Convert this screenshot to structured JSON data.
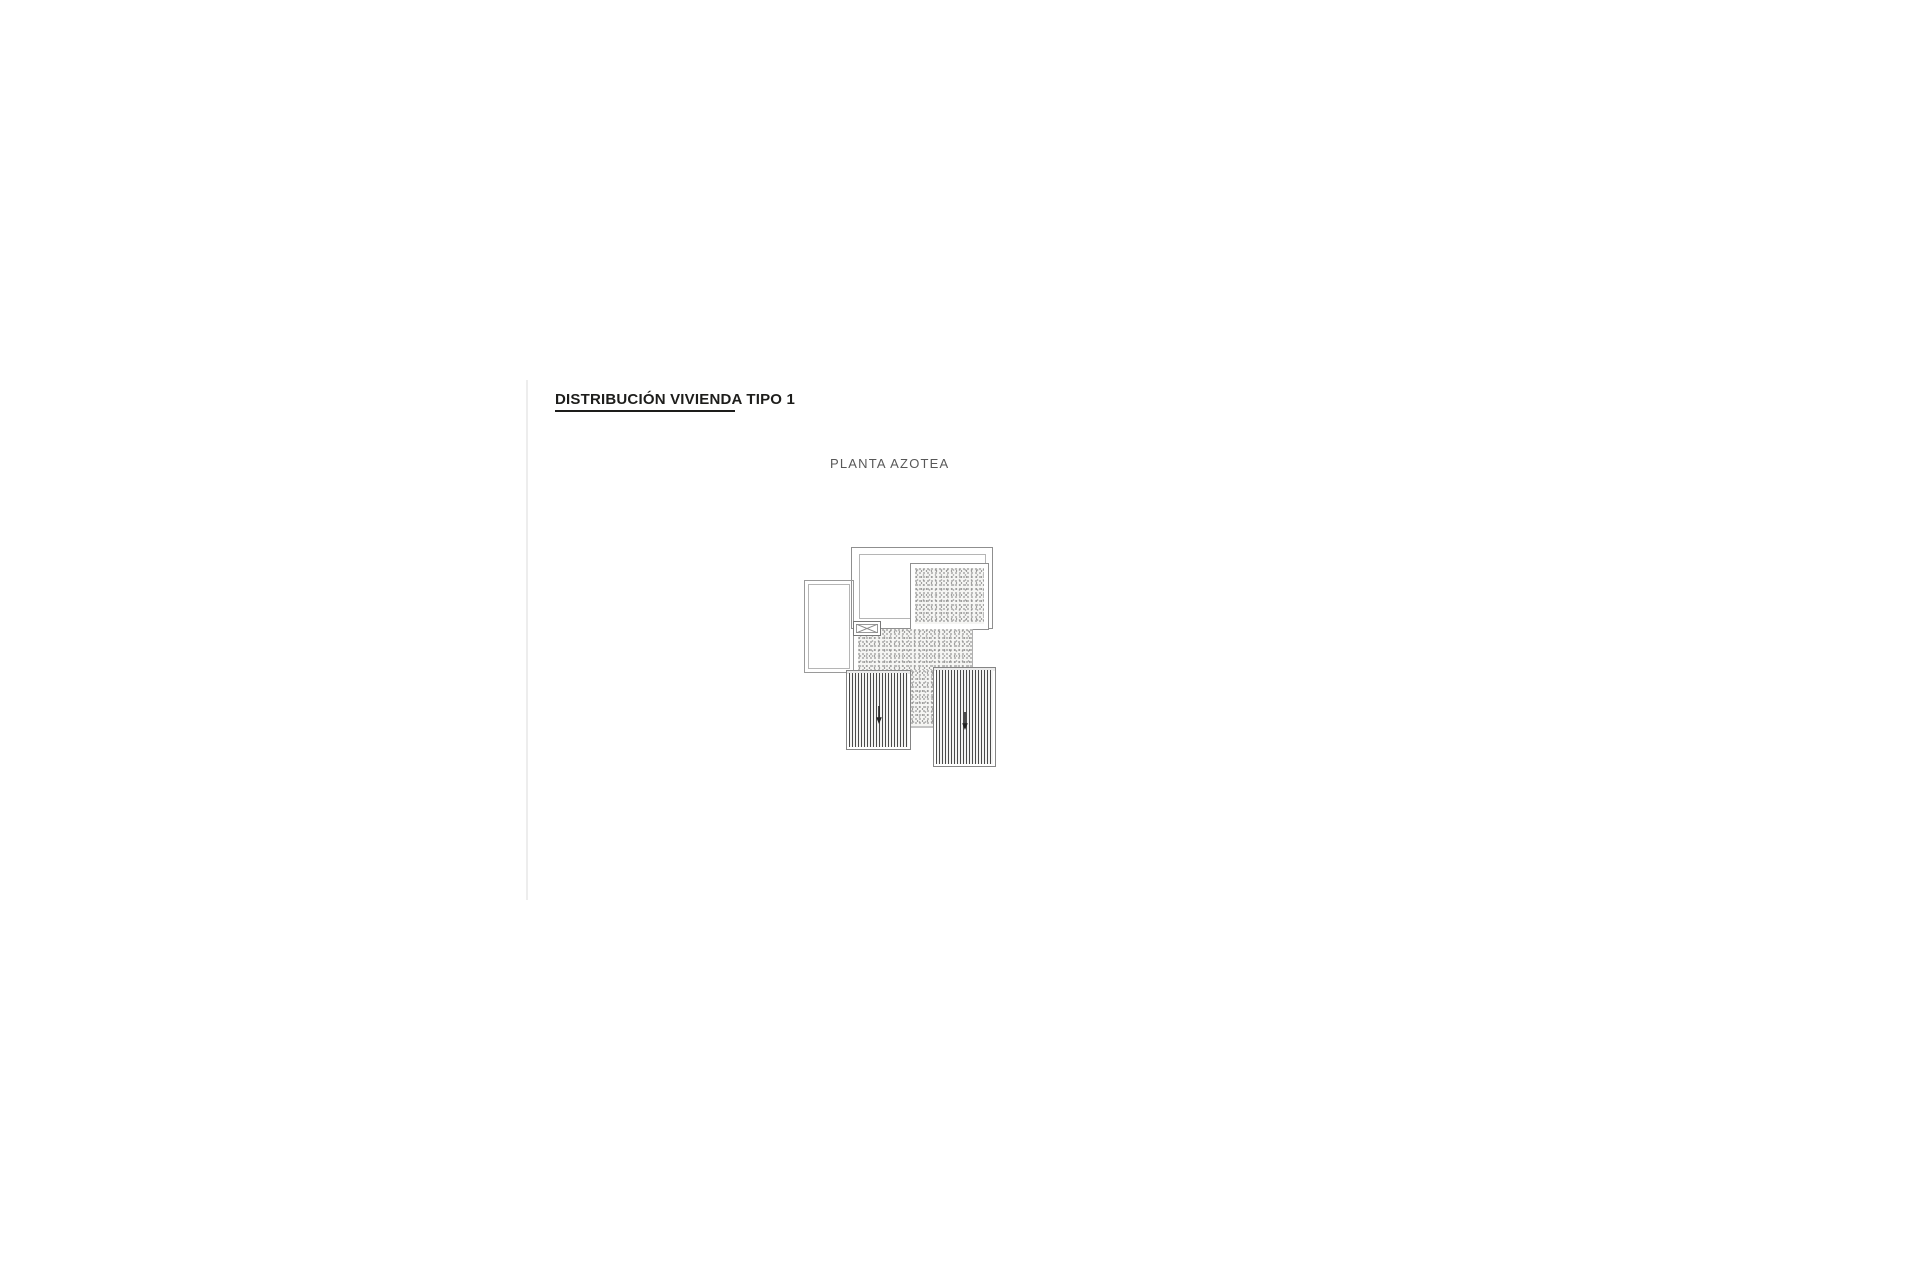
{
  "page": {
    "background": "#ffffff",
    "separator_color": "#ededed"
  },
  "header": {
    "title": "DISTRIBUCIÓN VIVIENDA TIPO 1",
    "title_color": "#1d1d1b",
    "underline_color": "#1d1d1b"
  },
  "figure": {
    "caption": "PLANTA AZOTEA",
    "caption_color": "#585858"
  },
  "plan": {
    "line_color": "#8f8f8f",
    "hatch_style": "stipple-gravel",
    "elements": [
      {
        "name": "roof-perimeter-outline"
      },
      {
        "name": "upper-terrace-area"
      },
      {
        "name": "gravel-roof-panel-top"
      },
      {
        "name": "side-annex-outline"
      },
      {
        "name": "skylight-box"
      },
      {
        "name": "gravel-roof-area-center"
      },
      {
        "name": "pergola-left",
        "arrow": "down"
      },
      {
        "name": "pergola-right",
        "arrow": "down"
      }
    ]
  }
}
